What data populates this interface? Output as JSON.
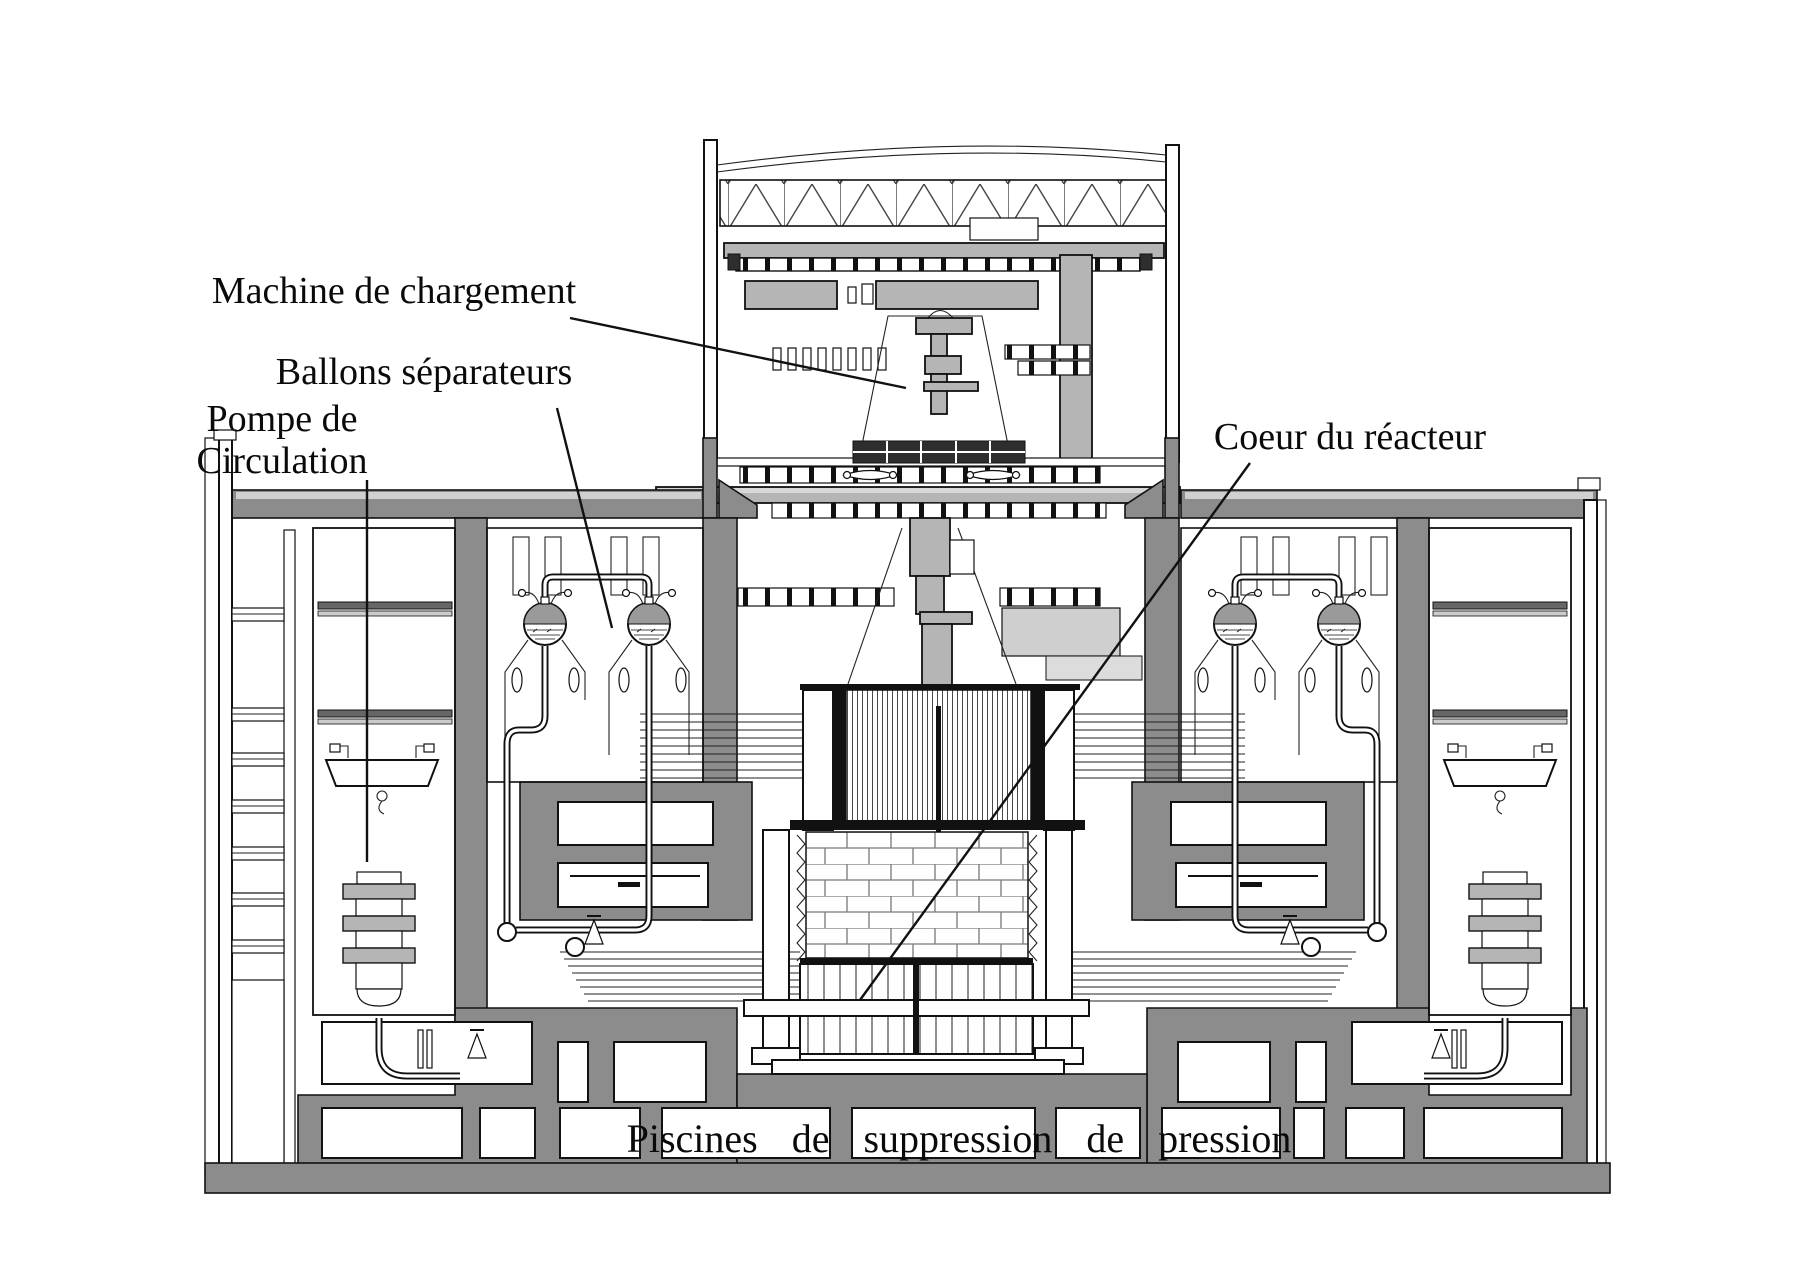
{
  "diagram": {
    "labels": {
      "machine_de_chargement": "Machine de chargement",
      "ballons_separateurs": "Ballons séparateurs",
      "pompe_de_circulation_line1": "Pompe de",
      "pompe_de_circulation_line2": "Circulation",
      "coeur_du_reacteur": "Coeur du réacteur",
      "piscines_de_suppression": "Piscines de suppression de pression"
    },
    "colors": {
      "background": "#ffffff",
      "outline": "#111111",
      "concrete_gray": "#8c8c8c",
      "machine_gray": "#b5b5b5",
      "light_gray": "#cfcfcf",
      "shield_block_dark": "#2e2e2e"
    }
  }
}
